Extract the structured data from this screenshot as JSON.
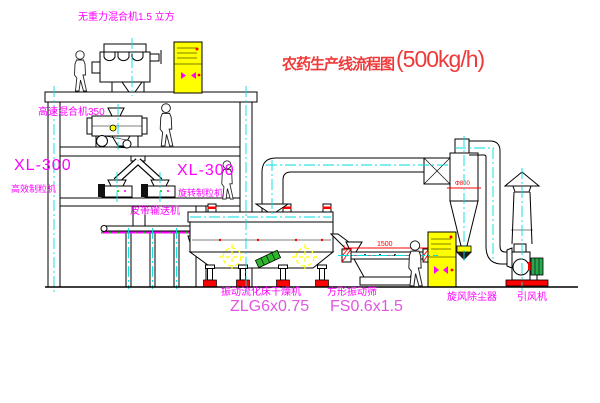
{
  "title": {
    "cn": "农药生产线流程图",
    "capacity": "(500kg/h)"
  },
  "labels": {
    "gravity_mixer": "无重力混合机1.5 立方",
    "high_speed_mixer": "高速混合机350",
    "granulator_left_model": "XL-300",
    "granulator_left_name": "高效制粒机",
    "granulator_center_model": "XL-300",
    "granulator_center_name": "旋转制粒机",
    "belt_conveyor": "皮带输送机",
    "dryer_name": "振动流化床干燥机",
    "dryer_model": "ZLG6x0.75",
    "screen_name": "方形振动筛",
    "screen_model": "FS0.6x1.5",
    "cyclone": "旋风除尘器",
    "fan": "引风机"
  },
  "dimensions": {
    "screen_width": "1500",
    "screen_height": "545",
    "cyclone_dia": "Φ800"
  },
  "colors": {
    "label_magenta": "#ff00ff",
    "model_magenta": "#e056e0",
    "title_red": "#ee3a3a",
    "centerline_cyan": "#00dede",
    "cabinet_yellow": "#ffff00",
    "accent_red": "#ff0000",
    "accent_green": "#2db52d"
  }
}
